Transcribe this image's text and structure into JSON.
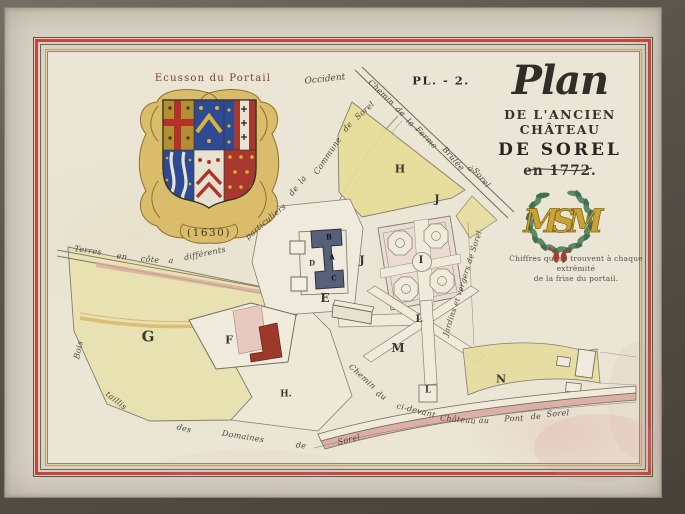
{
  "plate": {
    "number": "PL. - 2."
  },
  "title": {
    "word": "Plan",
    "line2": "DE L'ANCIEN CHÂTEAU",
    "line3": "DE SOREL",
    "line4": "en 1772."
  },
  "ecusson": {
    "label": "Ecusson du Portail",
    "year": "(1630)"
  },
  "compass": {
    "west_label": "Occident"
  },
  "monogram": {
    "letters": "MSM",
    "caption_line1": "Chiffres qui se trouvent à chaque extrémité",
    "caption_line2": "de la frise du portail."
  },
  "map": {
    "parcel_labels": [
      {
        "text": "G",
        "x": 148,
        "y": 337,
        "size": 15
      },
      {
        "text": "F",
        "x": 229,
        "y": 340,
        "size": 11
      },
      {
        "text": "H",
        "x": 400,
        "y": 169,
        "size": 11
      },
      {
        "text": "H.",
        "x": 286,
        "y": 395,
        "size": 9
      },
      {
        "text": "E",
        "x": 325,
        "y": 298,
        "size": 12
      },
      {
        "text": "D",
        "x": 312,
        "y": 263,
        "size": 7
      },
      {
        "text": "J",
        "x": 362,
        "y": 260,
        "size": 11
      },
      {
        "text": "J",
        "x": 437,
        "y": 199,
        "size": 11
      },
      {
        "text": "I",
        "x": 421,
        "y": 261,
        "size": 10
      },
      {
        "text": "L",
        "x": 419,
        "y": 320,
        "size": 10
      },
      {
        "text": "L",
        "x": 428,
        "y": 391,
        "size": 9
      },
      {
        "text": "M",
        "x": 398,
        "y": 348,
        "size": 12
      },
      {
        "text": "N",
        "x": 501,
        "y": 379,
        "size": 11
      },
      {
        "text": "B",
        "x": 329,
        "y": 237,
        "size": 7,
        "color": "#11151f"
      },
      {
        "text": "A",
        "x": 332,
        "y": 257,
        "size": 7,
        "color": "#11151f"
      },
      {
        "text": "C",
        "x": 334,
        "y": 278,
        "size": 7,
        "color": "#11151f"
      }
    ],
    "path_labels": [
      {
        "text": "Terres",
        "x": 88,
        "y": 251,
        "rot": 8,
        "size": 8
      },
      {
        "text": "en",
        "x": 122,
        "y": 257,
        "rot": 8,
        "size": 8
      },
      {
        "text": "côte",
        "x": 150,
        "y": 260,
        "rot": 6,
        "size": 8
      },
      {
        "text": "a",
        "x": 171,
        "y": 261,
        "rot": 4,
        "size": 8
      },
      {
        "text": "différents",
        "x": 205,
        "y": 254,
        "rot": -12,
        "size": 8
      },
      {
        "text": "particuliers",
        "x": 266,
        "y": 222,
        "rot": -40,
        "size": 8
      },
      {
        "text": "de",
        "x": 294,
        "y": 191,
        "rot": -52,
        "size": 8
      },
      {
        "text": "la",
        "x": 303,
        "y": 180,
        "rot": -52,
        "size": 8
      },
      {
        "text": "Commune",
        "x": 328,
        "y": 156,
        "rot": -56,
        "size": 8
      },
      {
        "text": "de",
        "x": 348,
        "y": 127,
        "rot": -50,
        "size": 8
      },
      {
        "text": "Sorel",
        "x": 365,
        "y": 111,
        "rot": -42,
        "size": 8
      },
      {
        "text": "Chemin",
        "x": 381,
        "y": 93,
        "rot": 44,
        "size": 8
      },
      {
        "text": "de",
        "x": 400,
        "y": 112,
        "rot": 44,
        "size": 8
      },
      {
        "text": "la",
        "x": 410,
        "y": 123,
        "rot": 44,
        "size": 8
      },
      {
        "text": "Ferme",
        "x": 426,
        "y": 138,
        "rot": 46,
        "size": 8
      },
      {
        "text": "Brûlée",
        "x": 453,
        "y": 159,
        "rot": 48,
        "size": 8
      },
      {
        "text": "à",
        "x": 470,
        "y": 169,
        "rot": 48,
        "size": 8
      },
      {
        "text": "Sorel",
        "x": 481,
        "y": 178,
        "rot": 50,
        "size": 8
      },
      {
        "text": "Jardins et vergers de Sorel.",
        "x": 463,
        "y": 282,
        "rot": -72,
        "size": 7.5
      },
      {
        "text": "Chemin",
        "x": 362,
        "y": 377,
        "rot": 42,
        "size": 8
      },
      {
        "text": "du",
        "x": 381,
        "y": 396,
        "rot": 32,
        "size": 8
      },
      {
        "text": "ci-devant",
        "x": 416,
        "y": 411,
        "rot": 14,
        "size": 8
      },
      {
        "text": "Château",
        "x": 458,
        "y": 420,
        "rot": 5,
        "size": 8
      },
      {
        "text": "au",
        "x": 484,
        "y": 421,
        "rot": 2,
        "size": 8
      },
      {
        "text": "Pont",
        "x": 514,
        "y": 419,
        "rot": -2,
        "size": 8
      },
      {
        "text": "de",
        "x": 536,
        "y": 417,
        "rot": -3,
        "size": 8
      },
      {
        "text": "Sorel",
        "x": 558,
        "y": 414,
        "rot": -4,
        "size": 8
      },
      {
        "text": "Bois",
        "x": 79,
        "y": 350,
        "rot": -78,
        "size": 8
      },
      {
        "text": "taillis",
        "x": 116,
        "y": 401,
        "rot": 38,
        "size": 8
      },
      {
        "text": "des",
        "x": 184,
        "y": 429,
        "rot": 14,
        "size": 8
      },
      {
        "text": "Domaines",
        "x": 243,
        "y": 437,
        "rot": 9,
        "size": 8
      },
      {
        "text": "de",
        "x": 301,
        "y": 446,
        "rot": 8,
        "size": 8
      },
      {
        "text": "Sorel",
        "x": 349,
        "y": 440,
        "rot": -14,
        "size": 8
      }
    ]
  },
  "colors": {
    "frame": "#5a544b",
    "mat": "#d9d3c5",
    "paper": "#eae5d4",
    "border_red": "#c5463c",
    "border_gold": "#bfa35e",
    "ink": "#3b382f",
    "script_ink": "#4c443a",
    "label_red": "#7c3b2e",
    "parcel_yellow": "#e6dc97",
    "parcel_green_yellow": "#e8e1ac",
    "road_pink": "#d9a79e",
    "building_dark": "#566078",
    "building_red": "#9c392b",
    "building_pink": "#e8c9c2",
    "shield_blue": "#2e4a93",
    "shield_red": "#a8372e",
    "shield_gold": "#b28f33",
    "cartouche_gold": "#d9bd6a",
    "wreath_green": "#3f7050",
    "monogram_gold": "#c9a232"
  }
}
